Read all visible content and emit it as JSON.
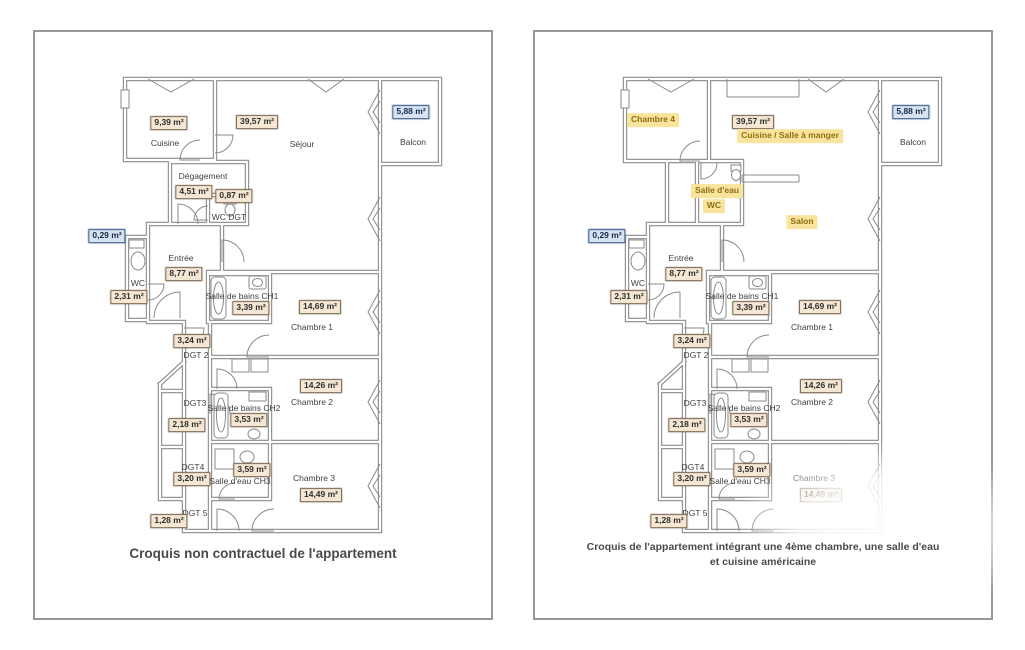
{
  "plans": {
    "left": {
      "caption": "Croquis non contractuel de l'appartement",
      "labels": {
        "cuisine": "Cuisine",
        "cuisine_area": "9,39 m²",
        "sejour": "Séjour",
        "sejour_area": "39,57 m²",
        "balcon": "Balcon",
        "balcon_area": "5,88 m²",
        "degagement": "Dégagement",
        "degagement_area": "4,51 m²",
        "wc_dgt": "WC DGT",
        "wc_dgt_area": "0,87 m²",
        "shaft_area": "0,29 m²",
        "entree": "Entrée",
        "entree_area": "8,77 m²",
        "wc": "WC",
        "wc_area": "2,31 m²",
        "sdb_ch1": "Salle de bains CH1",
        "sdb_ch1_area": "3,39 m²",
        "chambre1": "Chambre 1",
        "chambre1_area": "14,69 m²",
        "dgt2": "DGT 2",
        "dgt2_area": "3,24 m²",
        "chambre2": "Chambre 2",
        "chambre2_area": "14,26 m²",
        "dgt3": "DGT3",
        "dgt3_area": "2,18 m²",
        "sdb_ch2": "Salle de bains CH2",
        "sdb_ch2_area": "3,53 m²",
        "dgt4": "DGT4",
        "dgt4_area": "3,20 m²",
        "se_ch3": "Salle d'eau CH3",
        "se_ch3_area": "3,59 m²",
        "chambre3": "Chambre 3",
        "chambre3_area": "14,49 m²",
        "dgt5": "DGT 5",
        "dgt5_area": "1,28 m²"
      }
    },
    "right": {
      "caption_line1": "Croquis de l'appartement intégrant une 4ème chambre, une salle d'eau",
      "caption_line2": "et cuisine américaine",
      "highlights": {
        "chambre4": "Chambre 4",
        "cuisine_salle_a_manger": "Cuisine / Salle à manger",
        "salle_deau": "Salle d'eau",
        "wc": "WC",
        "salon": "Salon"
      },
      "labels": {
        "sejour_area": "39,57 m²",
        "balcon": "Balcon",
        "balcon_area": "5,88 m²",
        "shaft_area": "0,29 m²",
        "entree": "Entrée",
        "entree_area": "8,77 m²",
        "wc": "WC",
        "wc_area": "2,31 m²",
        "sdb_ch1": "Salle de bains CH1",
        "sdb_ch1_area": "3,39 m²",
        "chambre1": "Chambre 1",
        "chambre1_area": "14,69 m²",
        "dgt2": "DGT 2",
        "dgt2_area": "3,24 m²",
        "chambre2": "Chambre 2",
        "chambre2_area": "14,26 m²",
        "dgt3": "DGT3",
        "dgt3_area": "2,18 m²",
        "sdb_ch2": "Salle de bains CH2",
        "sdb_ch2_area": "3,53 m²",
        "dgt4": "DGT4",
        "dgt4_area": "3,20 m²",
        "se_ch3": "Salle d'eau CH3",
        "se_ch3_area": "3,59 m²",
        "chambre3": "Chambre 3",
        "chambre3_area": "14,49 m²",
        "dgt5": "DGT 5",
        "dgt5_area": "1,28 m²"
      }
    }
  },
  "colors": {
    "wall": "#8a8a8a",
    "area_box_bg": "#f5e7d3",
    "area_box_border": "#7e6c57",
    "blue_box_bg": "#d9e2f0",
    "blue_box_border": "#40618f",
    "highlight_bg": "#f8e49c",
    "highlight_text": "#8e6e12"
  }
}
